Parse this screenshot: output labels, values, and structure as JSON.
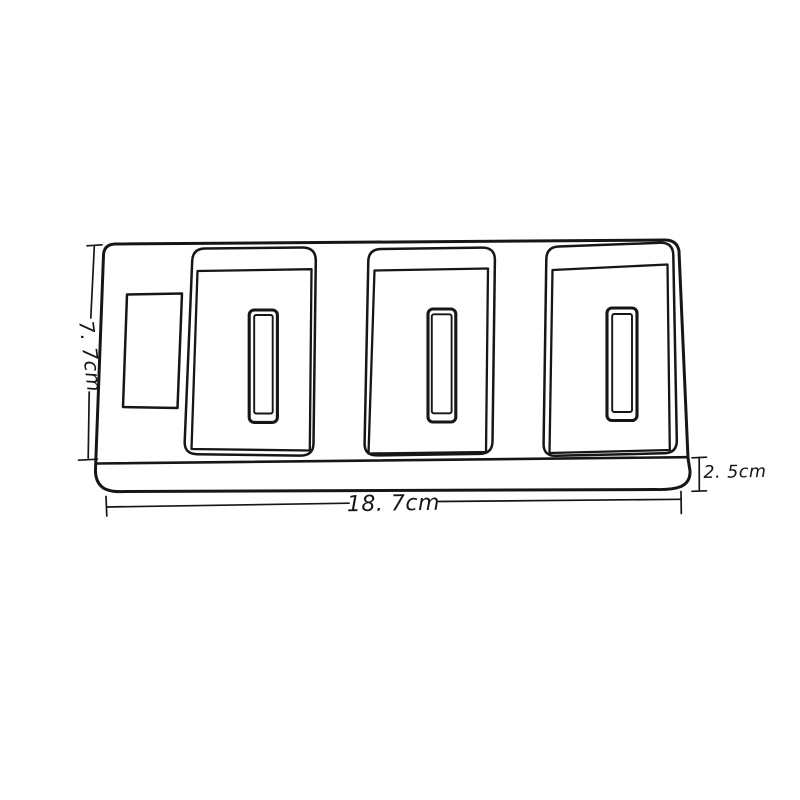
{
  "diagram": {
    "dimension_labels": {
      "height": "7. 7cm",
      "width": "18. 7cm",
      "thickness": "2. 5cm"
    },
    "colors": {
      "line": "#161616",
      "background": "#ffffff"
    }
  }
}
